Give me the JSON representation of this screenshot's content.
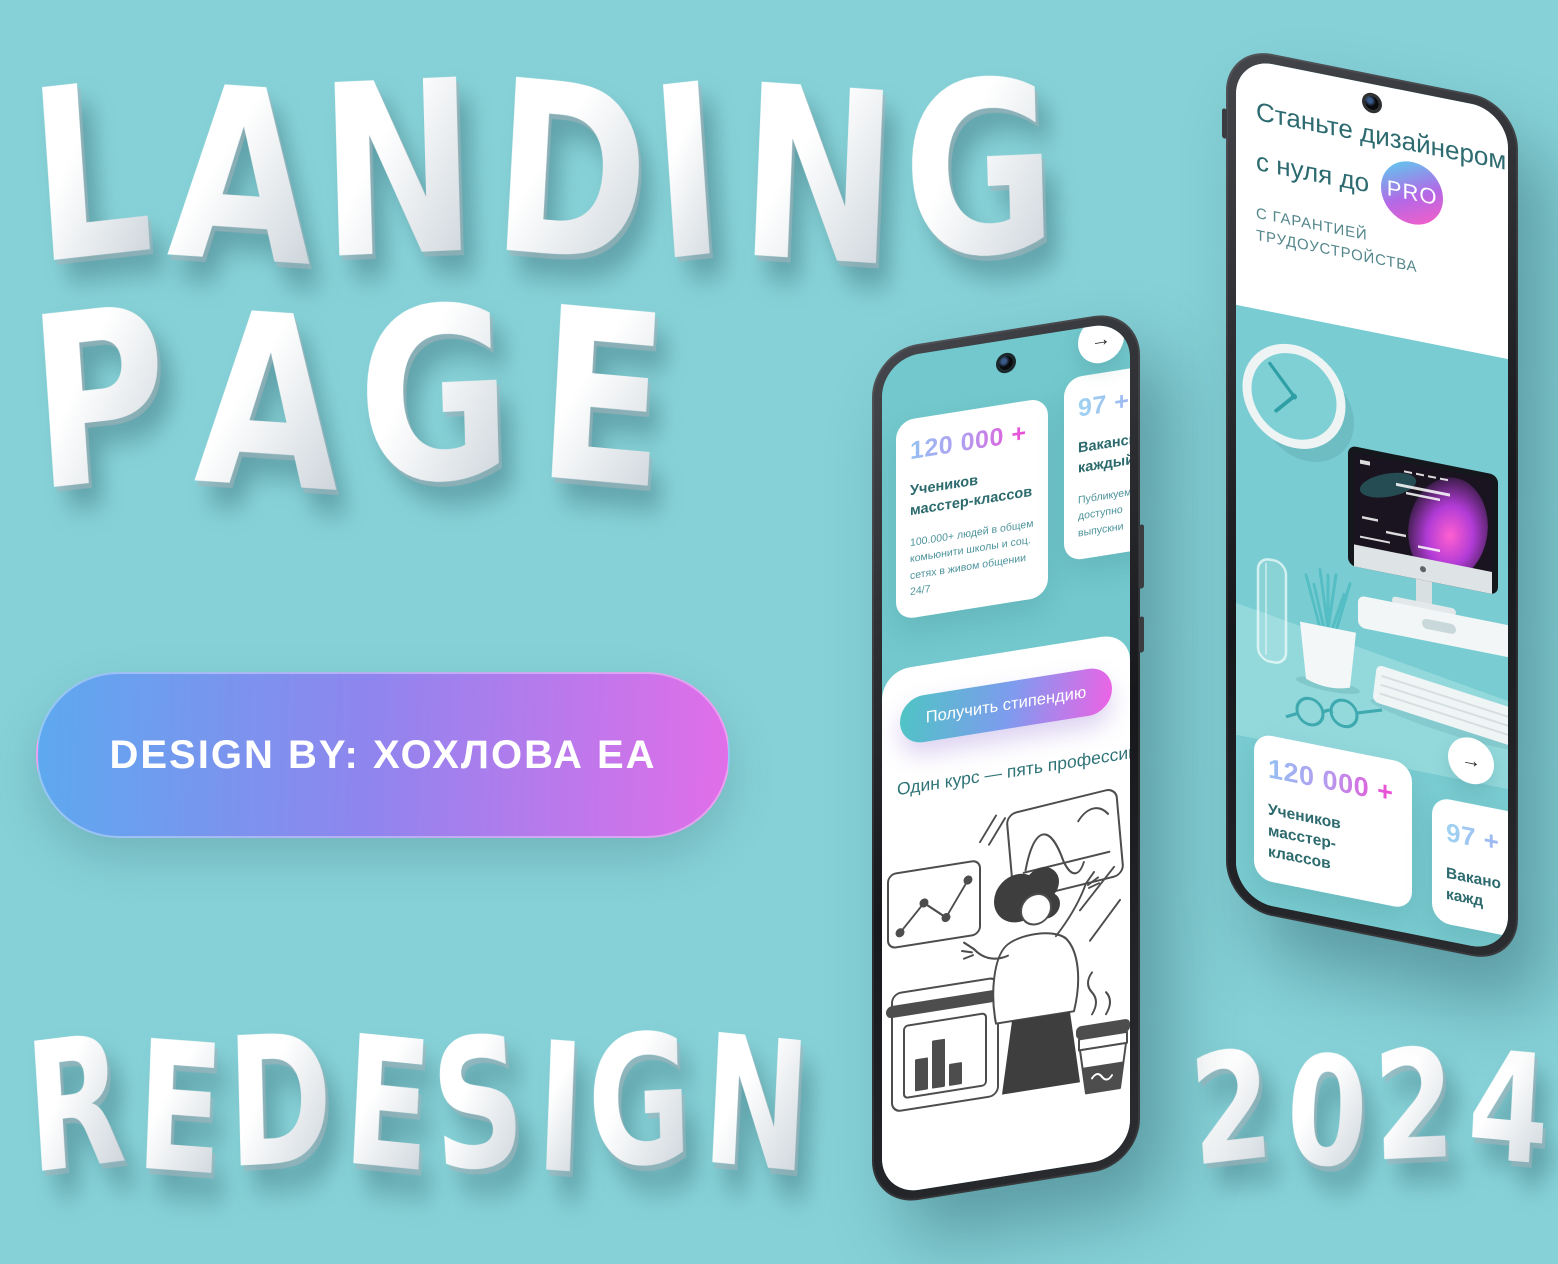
{
  "poster": {
    "title_line1": "LANDING",
    "title_line2": "PAGE",
    "footer_left": "REDESIGN",
    "footer_right": "2024",
    "credit_label": "DESIGN BY: ХОХЛОВА ЕА"
  },
  "colors": {
    "background": "#86d1d7",
    "screen_teal": "#72c8cc",
    "text_dark_teal": "#2c6a6d",
    "text_body_teal": "#4e939b",
    "pill_gradient_from": "#5da9ef",
    "pill_gradient_to": "#e16ee9",
    "number_gradient_from": "#93c1f2",
    "number_gradient_to": "#ef49d3",
    "cta_gradient_from": "#4ec5c4",
    "cta_gradient_to": "#ee62e5"
  },
  "phone_left": {
    "nav_arrow_glyph": "→",
    "stat_card_1": {
      "value": "120 000 +",
      "title": "Учеников масстер-классов",
      "body": "100.000+ людей в общем комьюнити школы и соц. сетях в живом общении 24/7"
    },
    "stat_card_2": {
      "value": "97 +",
      "title": "Вакансий\nкаждый",
      "body": "Публикуем\nдоступно\nвыпускни"
    },
    "cta_button_label": "Получить стипендию",
    "section_heading": "Один курс — пять профессий"
  },
  "phone_right": {
    "hero_title_line1": "Станьте дизайнером",
    "hero_title_line2": "с нуля до",
    "hero_badge": "PRO",
    "hero_subtitle": "С ГАРАНТИЕЙ\nТРУДОУСТРОЙСТВА",
    "nav_arrow_glyph": "→",
    "stat_card_1": {
      "value": "120 000 +",
      "title": "Учеников масстер-классов"
    },
    "stat_card_2": {
      "value": "97 +",
      "title": "Вакано\nкажд"
    }
  }
}
